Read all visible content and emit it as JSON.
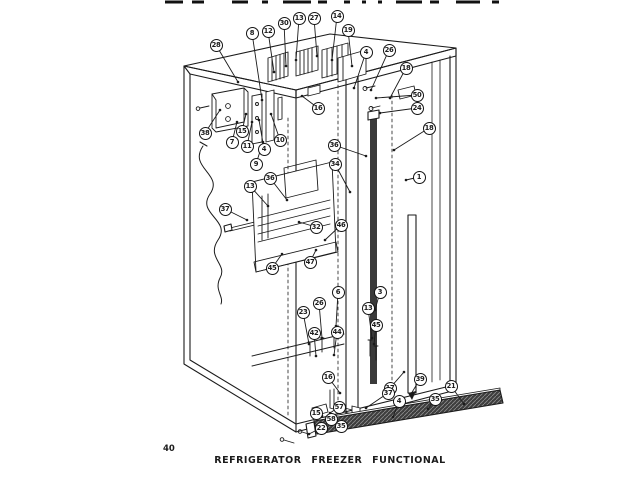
{
  "page": {
    "caption": "REFRIGERATOR FREEZER FUNCTIONAL",
    "page_number": "40",
    "paper_color": "#ffffff",
    "ink_color": "#1b1b1b"
  },
  "diagram": {
    "callouts": [
      {
        "n": "28",
        "x": 216,
        "y": 45,
        "tx": 238,
        "ty": 82
      },
      {
        "n": "8",
        "x": 252,
        "y": 33,
        "tx": 262,
        "ty": 100
      },
      {
        "n": "12",
        "x": 268,
        "y": 31,
        "tx": 274,
        "ty": 72
      },
      {
        "n": "30",
        "x": 284,
        "y": 23,
        "tx": 286,
        "ty": 66
      },
      {
        "n": "13",
        "x": 299,
        "y": 18,
        "tx": 296,
        "ty": 60
      },
      {
        "n": "27",
        "x": 314,
        "y": 18,
        "tx": 317,
        "ty": 56
      },
      {
        "n": "14",
        "x": 337,
        "y": 16,
        "tx": 332,
        "ty": 60
      },
      {
        "n": "19",
        "x": 348,
        "y": 30,
        "tx": 352,
        "ty": 66
      },
      {
        "n": "4",
        "x": 366,
        "y": 52,
        "tx": 354,
        "ty": 88
      },
      {
        "n": "26",
        "x": 389,
        "y": 50,
        "tx": 371,
        "ty": 90
      },
      {
        "n": "18",
        "x": 406,
        "y": 68,
        "tx": 390,
        "ty": 98
      },
      {
        "n": "50",
        "x": 417,
        "y": 95,
        "tx": 376,
        "ty": 98
      },
      {
        "n": "24",
        "x": 417,
        "y": 108,
        "tx": 380,
        "ty": 113
      },
      {
        "n": "18",
        "x": 429,
        "y": 128,
        "tx": 394,
        "ty": 150
      },
      {
        "n": "1",
        "x": 419,
        "y": 177,
        "tx": 406,
        "ty": 180
      },
      {
        "n": "36",
        "x": 334,
        "y": 145,
        "tx": 366,
        "ty": 156
      },
      {
        "n": "34",
        "x": 335,
        "y": 164,
        "tx": 350,
        "ty": 192
      },
      {
        "n": "16",
        "x": 318,
        "y": 108,
        "tx": 302,
        "ty": 96
      },
      {
        "n": "38",
        "x": 205,
        "y": 133,
        "tx": 220,
        "ty": 110
      },
      {
        "n": "7",
        "x": 232,
        "y": 142,
        "tx": 237,
        "ty": 122
      },
      {
        "n": "15",
        "x": 242,
        "y": 131,
        "tx": 246,
        "ty": 114
      },
      {
        "n": "11",
        "x": 247,
        "y": 146,
        "tx": 252,
        "ty": 122
      },
      {
        "n": "4",
        "x": 264,
        "y": 149,
        "tx": 259,
        "ty": 120
      },
      {
        "n": "10",
        "x": 280,
        "y": 140,
        "tx": 271,
        "ty": 114
      },
      {
        "n": "9",
        "x": 256,
        "y": 164,
        "tx": 263,
        "ty": 142
      },
      {
        "n": "36",
        "x": 270,
        "y": 178,
        "tx": 287,
        "ty": 200
      },
      {
        "n": "13",
        "x": 250,
        "y": 186,
        "tx": 268,
        "ty": 206
      },
      {
        "n": "37",
        "x": 225,
        "y": 209,
        "tx": 247,
        "ty": 220
      },
      {
        "n": "32",
        "x": 316,
        "y": 227,
        "tx": 299,
        "ty": 222
      },
      {
        "n": "46",
        "x": 341,
        "y": 225,
        "tx": 325,
        "ty": 240
      },
      {
        "n": "47",
        "x": 310,
        "y": 262,
        "tx": 316,
        "ty": 250
      },
      {
        "n": "45",
        "x": 272,
        "y": 268,
        "tx": 282,
        "ty": 254
      },
      {
        "n": "23",
        "x": 303,
        "y": 312,
        "tx": 309,
        "ty": 344
      },
      {
        "n": "26",
        "x": 319,
        "y": 303,
        "tx": 322,
        "ty": 338
      },
      {
        "n": "6",
        "x": 338,
        "y": 292,
        "tx": 336,
        "ty": 326
      },
      {
        "n": "42",
        "x": 314,
        "y": 333,
        "tx": 316,
        "ty": 356
      },
      {
        "n": "44",
        "x": 337,
        "y": 332,
        "tx": 334,
        "ty": 355
      },
      {
        "n": "16",
        "x": 328,
        "y": 377,
        "tx": 340,
        "ty": 393
      },
      {
        "n": "3",
        "x": 380,
        "y": 292,
        "tx": 375,
        "ty": 310
      },
      {
        "n": "13",
        "x": 368,
        "y": 308,
        "tx": 372,
        "ty": 338
      },
      {
        "n": "45",
        "x": 376,
        "y": 325,
        "tx": 374,
        "ty": 344
      },
      {
        "n": "17",
        "x": 390,
        "y": 388,
        "tx": 404,
        "ty": 372
      },
      {
        "n": "39",
        "x": 420,
        "y": 379,
        "tx": 411,
        "ty": 394
      },
      {
        "n": "21",
        "x": 451,
        "y": 386,
        "tx": 464,
        "ty": 404
      },
      {
        "n": "35",
        "x": 435,
        "y": 399,
        "tx": 428,
        "ty": 409
      },
      {
        "n": "37",
        "x": 388,
        "y": 393,
        "tx": 366,
        "ty": 408
      },
      {
        "n": "4",
        "x": 399,
        "y": 401,
        "tx": 393,
        "ty": 417
      },
      {
        "n": "57",
        "x": 339,
        "y": 407,
        "tx": 330,
        "ty": 413
      },
      {
        "n": "15",
        "x": 316,
        "y": 413,
        "tx": 322,
        "ty": 416
      },
      {
        "n": "58",
        "x": 331,
        "y": 419,
        "tx": 327,
        "ty": 420
      },
      {
        "n": "35",
        "x": 341,
        "y": 426,
        "tx": 334,
        "ty": 424
      },
      {
        "n": "22",
        "x": 321,
        "y": 428,
        "tx": 309,
        "ty": 434
      }
    ]
  }
}
